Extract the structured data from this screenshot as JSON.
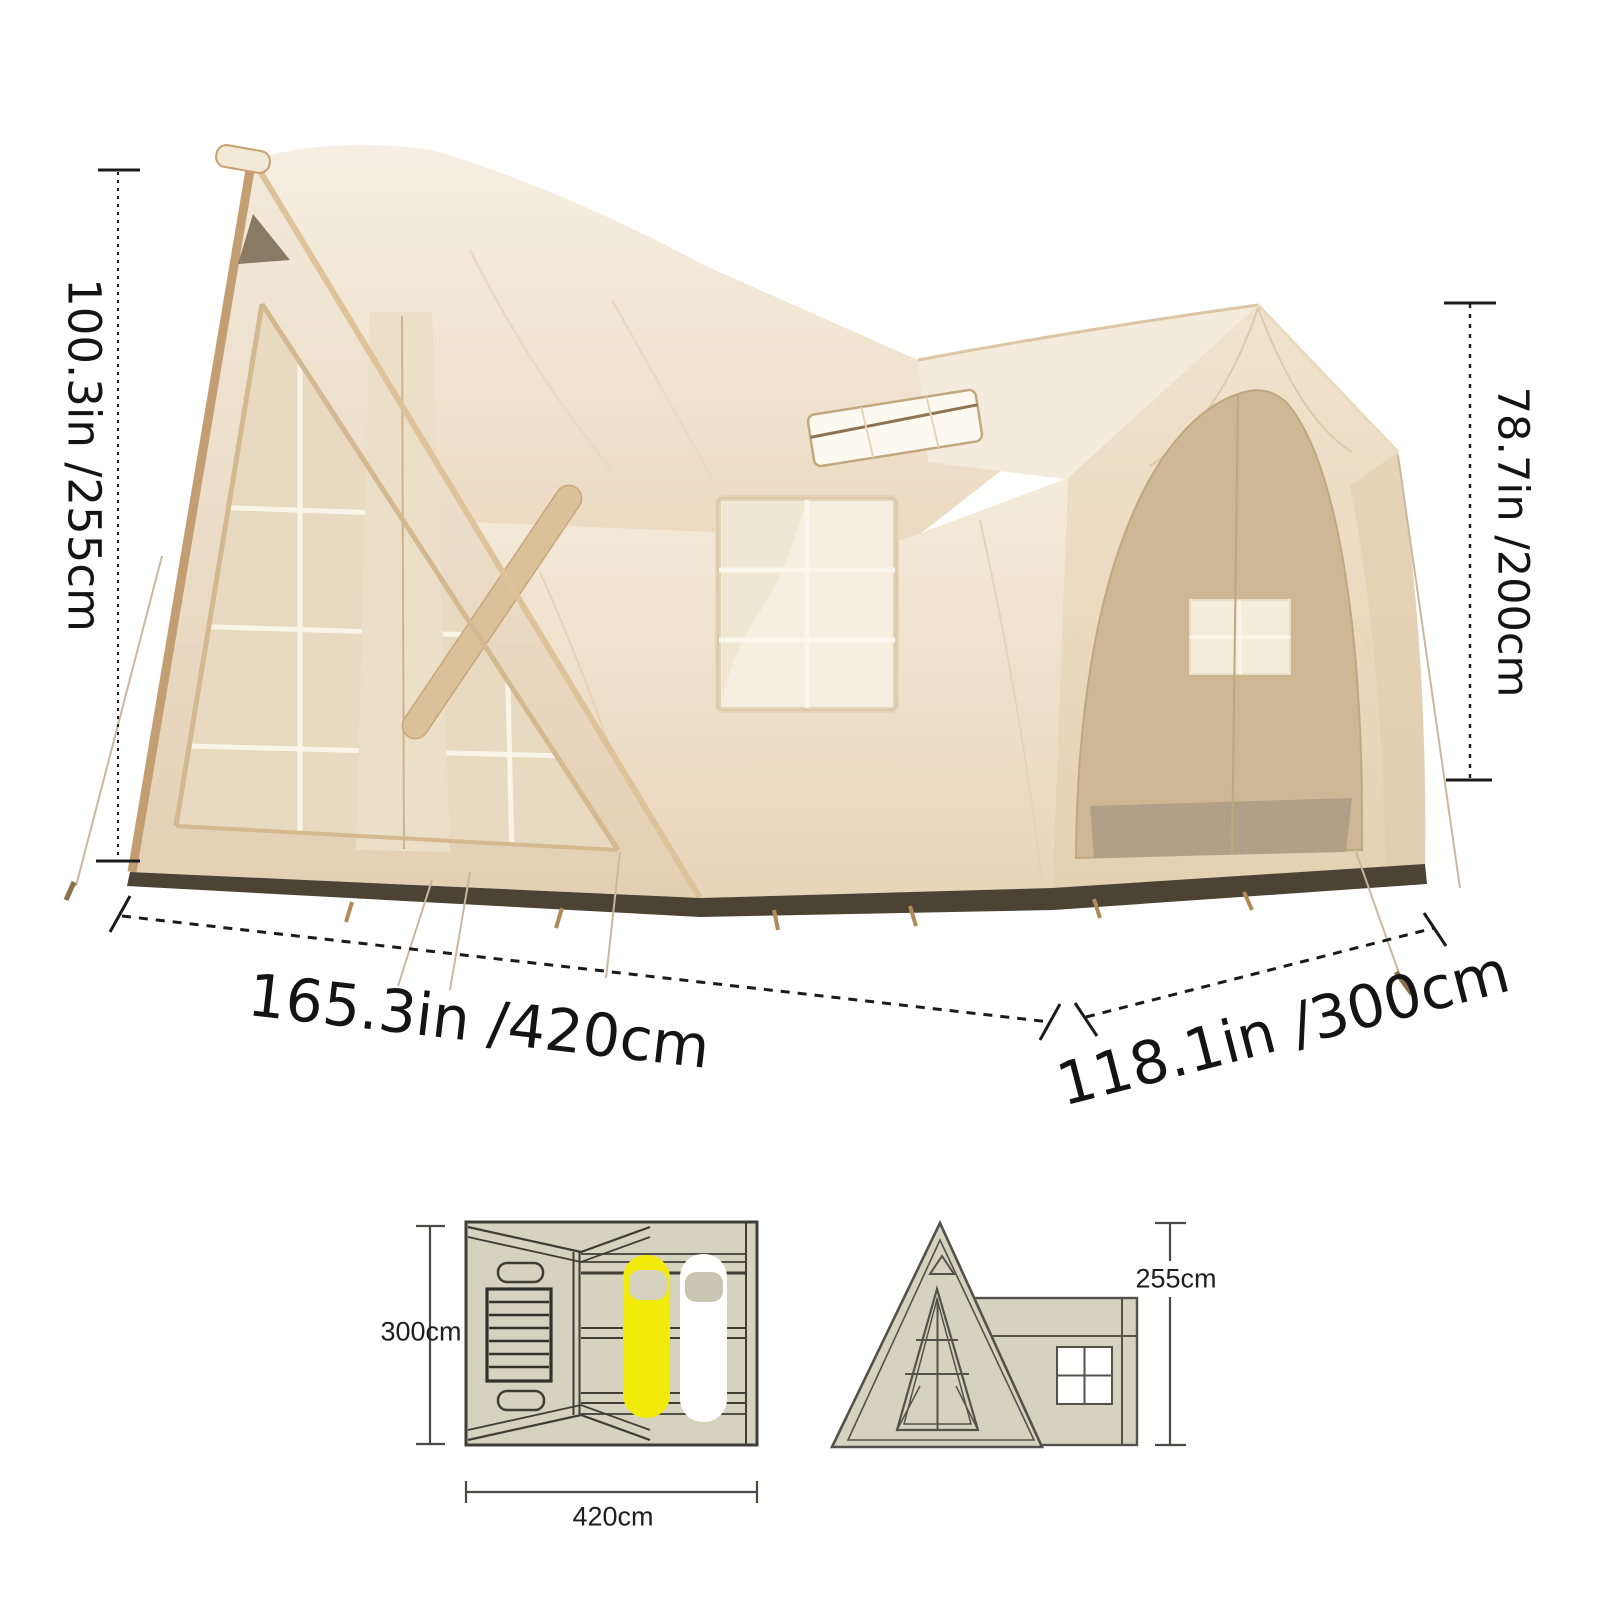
{
  "dimension_labels": {
    "total_height": "100.3in /255cm",
    "cabin_height": "78.7in /200cm",
    "width": "165.3in /420cm",
    "depth": "118.1in /300cm"
  },
  "floor_plan": {
    "depth": "300cm",
    "width": "420cm"
  },
  "front_elevation": {
    "height": "255cm"
  },
  "colors": {
    "highlight_yellow": "#f2ea0a",
    "canvas_light": "#f2e8d8",
    "canvas_shadow": "#d9c3a6",
    "mesh_tan": "#cdb795",
    "base_brown": "#4c4335",
    "diagram_fill": "#d5d2bf",
    "diagram_line": "#3e3e37",
    "dimension_line": "#1b1b1b"
  }
}
